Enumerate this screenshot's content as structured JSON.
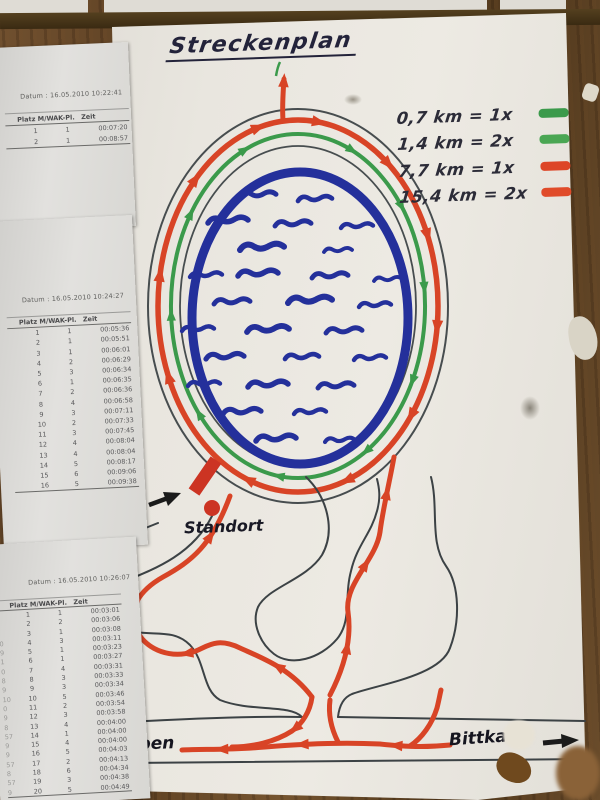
{
  "map": {
    "title": "Streckenplan",
    "legend": [
      {
        "text": "0,7 km = 1x",
        "color": "#3b9a4b"
      },
      {
        "text": "1,4 km = 2x",
        "color": "#4aa653"
      },
      {
        "text": "7,7 km = 1x",
        "color": "#dd4527"
      },
      {
        "text": "15,4 km = 2x",
        "color": "#e04b2a"
      }
    ],
    "labels": {
      "standort": "Standort",
      "start_ziel_fragment_top": "t /",
      "start_ziel_fragment_bottom": "el",
      "road_left": "eben",
      "road_right": "Bittkau"
    }
  },
  "result_sheets": [
    {
      "date_label": "Datum :",
      "date": "16.05.2010 10:22:41",
      "columns": [
        "Platz M/W",
        "AK-Pl.",
        "Zeit"
      ],
      "left_fragments": [
        "",
        ""
      ],
      "rows": [
        [
          "1",
          "1",
          "00:07:20"
        ],
        [
          "2",
          "1",
          "00:08:57"
        ]
      ]
    },
    {
      "date_label": "Datum :",
      "date": "16.05.2010 10:24:27",
      "columns": [
        "Platz M/W",
        "AK-Pl.",
        "Zeit"
      ],
      "left_fragments": [
        "",
        "",
        "",
        "",
        "",
        "",
        "",
        "",
        "",
        "",
        "",
        "",
        "",
        "",
        "",
        ""
      ],
      "rows": [
        [
          "1",
          "1",
          "00:05:36"
        ],
        [
          "2",
          "1",
          "00:05:51"
        ],
        [
          "3",
          "1",
          "00:06:01"
        ],
        [
          "4",
          "2",
          "00:06:29"
        ],
        [
          "5",
          "3",
          "00:06:34"
        ],
        [
          "6",
          "1",
          "00:06:35"
        ],
        [
          "7",
          "2",
          "00:06:36"
        ],
        [
          "8",
          "4",
          "00:06:58"
        ],
        [
          "9",
          "3",
          "00:07:11"
        ],
        [
          "10",
          "2",
          "00:07:33"
        ],
        [
          "11",
          "3",
          "00:07:45"
        ],
        [
          "12",
          "4",
          "00:08:04"
        ],
        [
          "13",
          "4",
          "00:08:04"
        ],
        [
          "14",
          "5",
          "00:08:17"
        ],
        [
          "15",
          "6",
          "00:09:06"
        ],
        [
          "16",
          "5",
          "00:09:38"
        ]
      ]
    },
    {
      "date_label": "Datum :",
      "date": "16.05.2010 10:26:07",
      "columns": [
        "Platz M/W",
        "AK-Pl.",
        "Zeit"
      ],
      "left_fragments": [
        "",
        "",
        "",
        "0",
        "9",
        "1",
        "0",
        "8",
        "9",
        "10",
        "0",
        "9",
        "8",
        "57",
        "9",
        "9",
        "57",
        "8",
        "57",
        "9"
      ],
      "rows": [
        [
          "1",
          "1",
          "00:03:01"
        ],
        [
          "2",
          "2",
          "00:03:06"
        ],
        [
          "3",
          "1",
          "00:03:08"
        ],
        [
          "4",
          "3",
          "00:03:11"
        ],
        [
          "5",
          "1",
          "00:03:23"
        ],
        [
          "6",
          "1",
          "00:03:27"
        ],
        [
          "7",
          "4",
          "00:03:31"
        ],
        [
          "8",
          "3",
          "00:03:33"
        ],
        [
          "9",
          "3",
          "00:03:34"
        ],
        [
          "10",
          "5",
          "00:03:46"
        ],
        [
          "11",
          "2",
          "00:03:54"
        ],
        [
          "12",
          "3",
          "00:03:58"
        ],
        [
          "13",
          "4",
          "00:04:00"
        ],
        [
          "14",
          "1",
          "00:04:00"
        ],
        [
          "15",
          "4",
          "00:04:00"
        ],
        [
          "16",
          "5",
          "00:04:03"
        ],
        [
          "17",
          "2",
          "00:04:13"
        ],
        [
          "18",
          "6",
          "00:04:34"
        ],
        [
          "19",
          "3",
          "00:04:38"
        ],
        [
          "20",
          "5",
          "00:04:49"
        ]
      ]
    }
  ],
  "colors": {
    "route_red": "#d84426",
    "route_green": "#3b9a4b",
    "lake_blue": "#24309b",
    "outline_ink": "#3c4245",
    "marker_red": "#cc3423",
    "ink": "#23233a",
    "board_brown": "#6b4a2a"
  }
}
